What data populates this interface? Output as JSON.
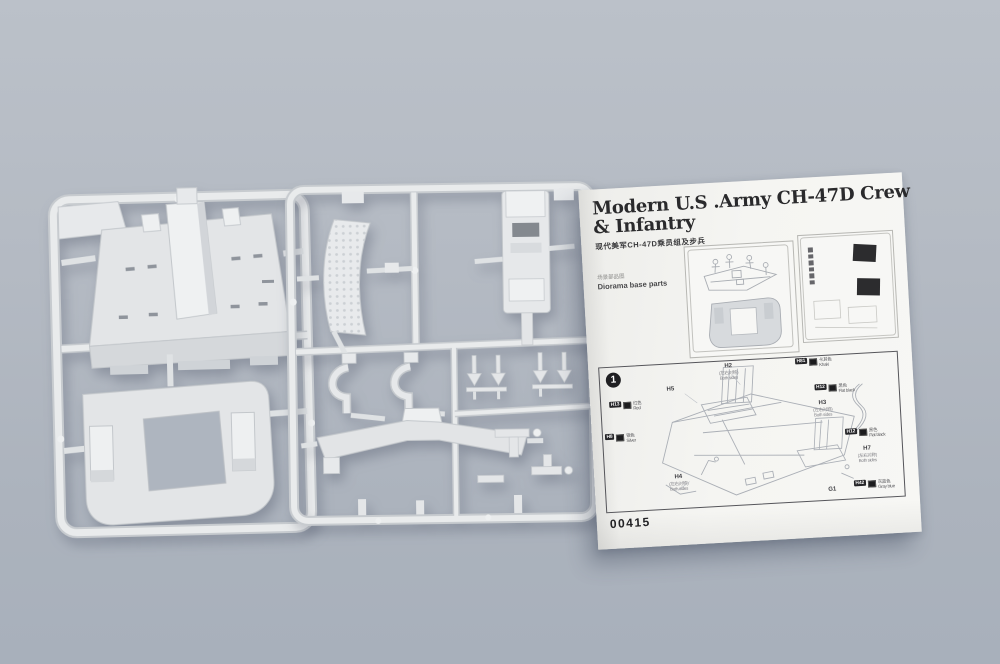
{
  "colors": {
    "background_top": "#bbc1c9",
    "background_bottom": "#a8b0bb",
    "plastic": "#e5e7e9",
    "paper": "#f4f4f1",
    "ink": "#2a2a2c",
    "paint_chip": "#1c1c1e"
  },
  "sheet": {
    "title_line1": "Modern U.S .Army  CH-47D Crew",
    "title_line2": "& Infantry",
    "subtitle_cn": "现代美军CH-47D乘员组及步兵",
    "diagram_label_cn": "场景部品图",
    "diagram_label_en": "Diorama base parts",
    "step_number": "1",
    "kit_number": "00415",
    "part_labels": [
      {
        "code": "H2",
        "note_cn": "(左右对称)",
        "note_en": "Both sides"
      },
      {
        "code": "H5",
        "note_cn": "",
        "note_en": ""
      },
      {
        "code": "H4",
        "note_cn": "(左右对称)",
        "note_en": "Both sides"
      },
      {
        "code": "H3",
        "note_cn": "(左右对称)",
        "note_en": "Both sides"
      },
      {
        "code": "H7",
        "note_cn": "(左右对称)",
        "note_en": "Both sides"
      },
      {
        "code": "G1",
        "note_cn": "",
        "note_en": ""
      }
    ],
    "paint_callouts": [
      {
        "code": "H13",
        "name_cn": "红色",
        "name_en": "Red"
      },
      {
        "code": "H8",
        "name_cn": "银色",
        "name_en": "Silver"
      },
      {
        "code": "H81",
        "name_cn": "卡其色",
        "name_en": "Khaki"
      },
      {
        "code": "H12",
        "name_cn": "黑色",
        "name_en": "Flat black"
      },
      {
        "code": "H12",
        "name_cn": "黑色",
        "name_en": "Flat black"
      },
      {
        "code": "H42",
        "name_cn": "灰蓝色",
        "name_en": "Gray blue"
      }
    ]
  }
}
